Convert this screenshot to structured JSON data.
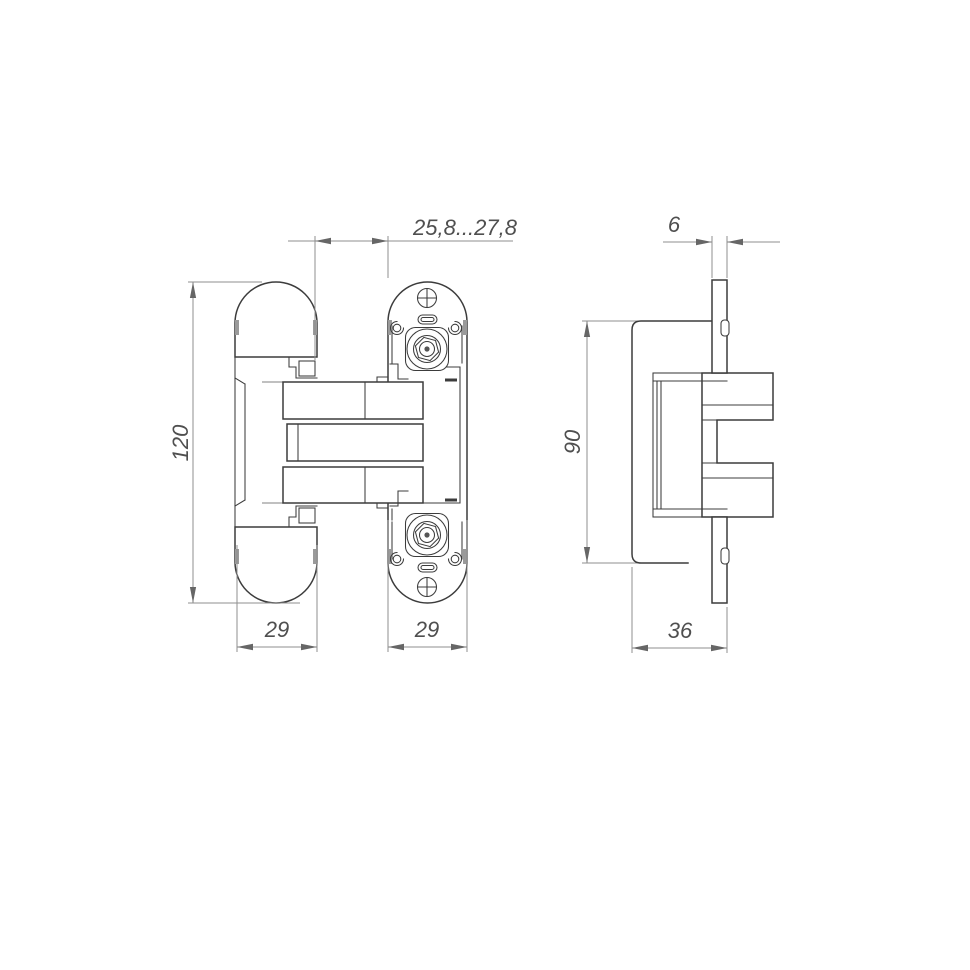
{
  "meta": {
    "background": "#ffffff",
    "line_color": "#3c3c3c",
    "dim_line_color": "#8f8f8f",
    "text_color": "#4f4f4f",
    "subject": "concealed hinge technical drawing, front view and side view"
  },
  "front_view": {
    "label": "front-view",
    "dim_gap": "25,8...27,8",
    "dim_overall_height": "120",
    "dim_door_wing_width": "29",
    "dim_frame_wing_width": "29"
  },
  "side_view": {
    "label": "side-view",
    "dim_plate_thickness": "6",
    "dim_body_height": "90",
    "dim_body_width": "36"
  }
}
